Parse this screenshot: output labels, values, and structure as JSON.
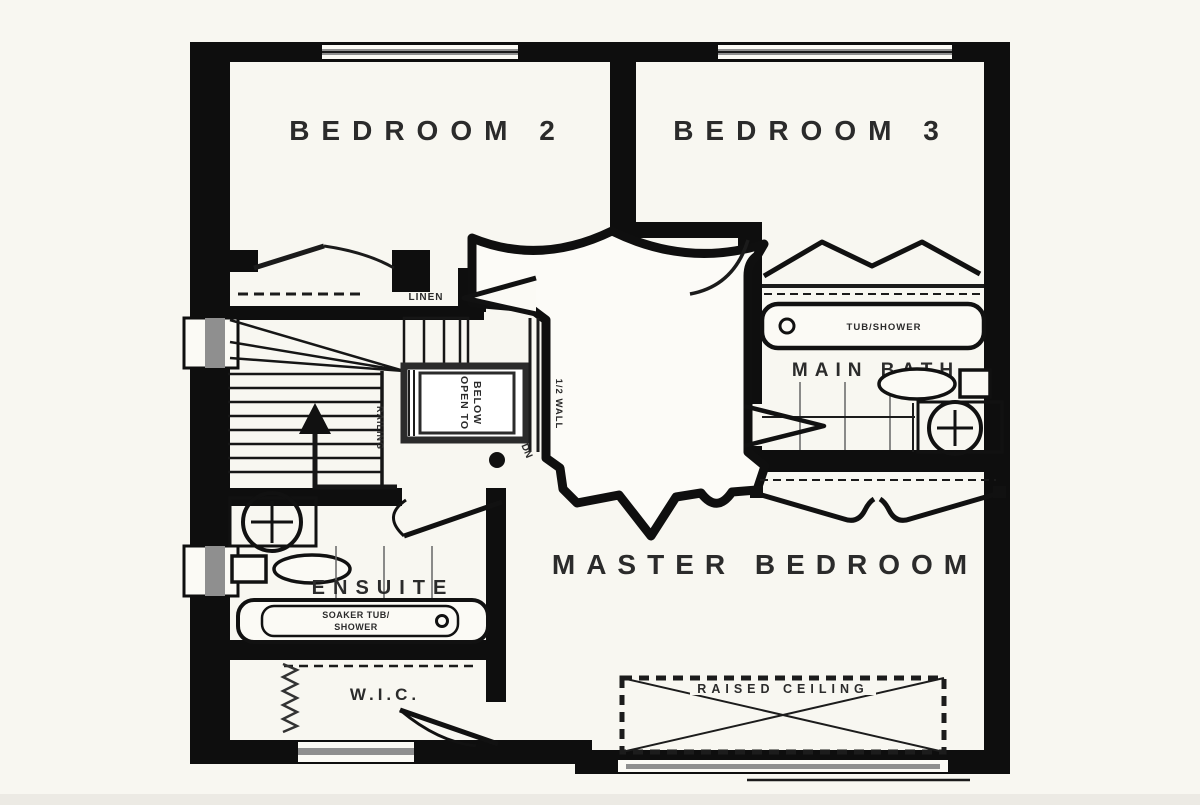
{
  "floor_plan": {
    "rooms": {
      "bedroom2": "BEDROOM 2",
      "bedroom3": "BEDROOM 3",
      "master_bedroom": "MASTER BEDROOM",
      "ensuite": "ENSUITE",
      "wic": "W.I.C.",
      "main_bath": "MAIN BATH",
      "linen": "LINEN"
    },
    "fixtures": {
      "tub_shower": "TUB/SHOWER",
      "soaker_tub_line1": "SOAKER TUB/",
      "soaker_tub_line2": "SHOWER"
    },
    "annotations": {
      "open_to_below_line1": "OPEN TO",
      "open_to_below_line2": "BELOW",
      "railing": "RAILING",
      "half_wall": "1/2 WALL",
      "down": "DN",
      "raised_ceiling": "RAISED CEILING"
    },
    "icons": {
      "up_arrow": "stairs-up-arrow",
      "sink": "sink-basin-cross",
      "toilet": "toilet-tank-and-bowl",
      "door_swing": "door-swing-arc",
      "bifold_doors": "bifold-closet-doors",
      "hanging_rod": "closet-hanging-rod",
      "window": "window-glass-band"
    },
    "colors": {
      "background": "#f8f7f1",
      "wall": "#0e0e0e",
      "window_glass": "#8f8f8f",
      "text": "#2b2b2b",
      "footer_strip": "#eceae4"
    }
  }
}
